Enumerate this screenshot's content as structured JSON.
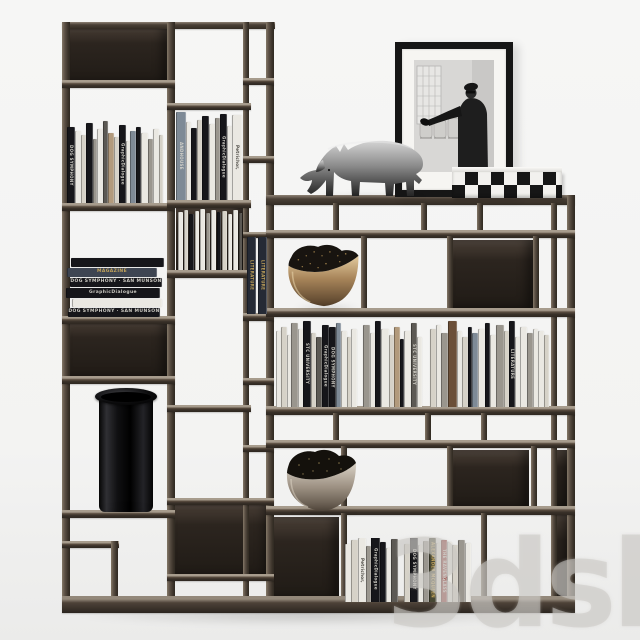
{
  "scene": {
    "description": "modular dark-bronze bookshelf with books and decor objects"
  },
  "watermark": {
    "text": "3dsky"
  },
  "colors": {
    "background": "#f4f4f3",
    "frame_dark": "#342d26",
    "frame_mid": "#55493d",
    "frame_light": "#a1968a",
    "panel_dark": "#241f1b",
    "bronze": "#a98a5f",
    "silver": "#9d9183",
    "gold_text": "#c9a85c",
    "watermark_gray": "#cdcbc8"
  },
  "objects": [
    {
      "name": "rhino-sculpture",
      "material": "polished metal"
    },
    {
      "name": "framed-photo",
      "style": "black and white photograph, black frame, white mat"
    },
    {
      "name": "checkered-box",
      "pattern": "black and white checkerboard"
    },
    {
      "name": "bronze-bowl-upper"
    },
    {
      "name": "bronze-bowl-lower"
    },
    {
      "name": "black-glass-vase"
    }
  ],
  "books": {
    "visible_titles": [
      "DOG SYMPHONY",
      "SAN MUNSON",
      "GraphicDialogue",
      "Petrichor,",
      "LITERATURE",
      "STC UNIVERSITY",
      "ALEXANDER MCQUEEN",
      "THE RAVENGLASS",
      "MAGAZINE",
      "ANDHOUSE"
    ],
    "palette": {
      "k": "#16161a",
      "w": "#eae8e2",
      "c": "#d6d2c8",
      "g": "#9a968e",
      "dg": "#5c5954",
      "sl": "#7e8a96",
      "tn": "#b29a7c",
      "br": "#6b4f38",
      "nv": "#252a35",
      "rd": "#8e3330",
      "gn": "#474733"
    },
    "groups": {
      "left_top": {
        "items": [
          [
            8,
            76,
            "k",
            "DOG SYMPHONY"
          ],
          [
            6,
            72,
            "w"
          ],
          [
            5,
            68,
            "c"
          ],
          [
            7,
            80,
            "k"
          ],
          [
            4,
            64,
            "g"
          ],
          [
            6,
            74,
            "w"
          ],
          [
            5,
            82,
            "dg"
          ],
          [
            6,
            70,
            "tn"
          ],
          [
            5,
            66,
            "c"
          ],
          [
            7,
            78,
            "k",
            "GraphicDialogue"
          ],
          [
            4,
            62,
            "w"
          ],
          [
            6,
            72,
            "sl"
          ],
          [
            5,
            76,
            "k"
          ],
          [
            7,
            70,
            "w"
          ],
          [
            5,
            64,
            "g"
          ],
          [
            6,
            74,
            "w"
          ],
          [
            4,
            68,
            "c"
          ]
        ]
      },
      "mid_top": {
        "items": [
          [
            10,
            88,
            "sl",
            "ANDHOUSE"
          ],
          [
            5,
            78,
            "w"
          ],
          [
            6,
            72,
            "k"
          ],
          [
            5,
            80,
            "c"
          ],
          [
            7,
            84,
            "k"
          ],
          [
            6,
            76,
            "w"
          ],
          [
            5,
            82,
            "g"
          ],
          [
            7,
            86,
            "k",
            "GraphicDialogue"
          ],
          [
            5,
            74,
            "w"
          ],
          [
            10,
            85,
            "w",
            "Petrichor,"
          ]
        ]
      },
      "flat_stack": {
        "items": [
          [
            5,
            58,
            "w"
          ],
          [
            4,
            60,
            "c"
          ],
          [
            5,
            56,
            "k"
          ],
          [
            4,
            59,
            "w"
          ],
          [
            5,
            61,
            "w"
          ],
          [
            4,
            57,
            "g"
          ],
          [
            5,
            60,
            "w"
          ],
          [
            4,
            58,
            "k"
          ],
          [
            5,
            59,
            "c"
          ],
          [
            4,
            56,
            "w"
          ],
          [
            5,
            60,
            "w"
          ],
          [
            4,
            57,
            "dg"
          ],
          [
            5,
            59,
            "w"
          ]
        ]
      },
      "gold_pair": {
        "items": [
          [
            9,
            77,
            "nv",
            "LITERATURE"
          ],
          [
            "gap",
            2
          ],
          [
            9,
            77,
            "nv",
            "LITERATURE"
          ]
        ]
      },
      "stack_horizontal": {
        "horizontal": true,
        "items": [
          [
            92,
            9,
            "k",
            "DOG SYMPHONY  ·  SAN MUNSON"
          ],
          [
            90,
            8,
            "w"
          ],
          [
            94,
            10,
            "k",
            "GraphicDialogue"
          ],
          [
            92,
            9,
            "k",
            "DOG SYMPHONY  ·  SAN MUNSON"
          ],
          [
            90,
            9,
            "bl",
            "MAGAZINE"
          ],
          [
            93,
            9,
            "k"
          ]
        ]
      },
      "long_row": {
        "items": [
          [
            5,
            76,
            "w"
          ],
          [
            6,
            80,
            "c"
          ],
          [
            4,
            72,
            "w"
          ],
          [
            7,
            84,
            "g"
          ],
          [
            5,
            78,
            "w"
          ],
          [
            8,
            86,
            "k",
            "STC UNIVERSITY"
          ],
          [
            5,
            74,
            "c"
          ],
          [
            6,
            70,
            "dg"
          ],
          [
            7,
            82,
            "k",
            "GraphicDialogue"
          ],
          [
            7,
            80,
            "k",
            "DOG SYMPHONY"
          ],
          [
            5,
            84,
            "sl"
          ],
          [
            6,
            76,
            "w"
          ],
          [
            4,
            70,
            "c"
          ],
          [
            6,
            78,
            "w"
          ],
          [
            "gap",
            6
          ],
          [
            7,
            82,
            "g"
          ],
          [
            5,
            74,
            "w"
          ],
          [
            6,
            86,
            "k"
          ],
          [
            8,
            78,
            "w"
          ],
          [
            5,
            72,
            "c"
          ],
          [
            6,
            80,
            "tn"
          ],
          [
            4,
            68,
            "k"
          ],
          [
            7,
            76,
            "w"
          ],
          [
            6,
            84,
            "dg",
            "STC UNIVERSITY"
          ],
          [
            5,
            70,
            "w"
          ],
          [
            "gap",
            8
          ],
          [
            6,
            78,
            "c"
          ],
          [
            5,
            82,
            "w"
          ],
          [
            7,
            74,
            "g"
          ],
          [
            9,
            86,
            "br"
          ],
          [
            5,
            76,
            "w"
          ],
          [
            6,
            70,
            "c"
          ],
          [
            4,
            80,
            "k"
          ],
          [
            6,
            74,
            "sl"
          ],
          [
            7,
            78,
            "w"
          ],
          [
            5,
            84,
            "k"
          ],
          [
            6,
            72,
            "w"
          ],
          [
            8,
            82,
            "g"
          ],
          [
            5,
            76,
            "c"
          ],
          [
            6,
            86,
            "k",
            "LITERATURE"
          ],
          [
            5,
            70,
            "w"
          ],
          [
            7,
            80,
            "w"
          ],
          [
            6,
            74,
            "g"
          ],
          [
            5,
            78,
            "w"
          ],
          [
            6,
            76,
            "w"
          ],
          [
            5,
            72,
            "c"
          ]
        ]
      },
      "bottom_row": {
        "items": [
          [
            6,
            58,
            "w"
          ],
          [
            7,
            62,
            "c"
          ],
          [
            8,
            64,
            "w",
            "Petrichor,"
          ],
          [
            5,
            56,
            "g"
          ],
          [
            9,
            66,
            "k",
            "GraphicDialogue"
          ],
          [
            6,
            60,
            "k"
          ],
          [
            5,
            54,
            "w"
          ],
          [
            7,
            63,
            "dg"
          ],
          [
            "gap",
            6
          ],
          [
            6,
            58,
            "c"
          ],
          [
            8,
            65,
            "k",
            "DOG SYMPHONY"
          ],
          [
            5,
            57,
            "w"
          ],
          [
            6,
            61,
            "g"
          ],
          [
            7,
            64,
            "gn",
            "ALEXANDER MCQUEEN"
          ],
          [
            5,
            59,
            "w"
          ],
          [
            6,
            62,
            "rd",
            "THE RAVENGLASS"
          ],
          [
            5,
            60,
            "w"
          ],
          [
            6,
            57,
            "c"
          ],
          [
            7,
            62,
            "g"
          ],
          [
            6,
            59,
            "w"
          ]
        ]
      }
    }
  }
}
